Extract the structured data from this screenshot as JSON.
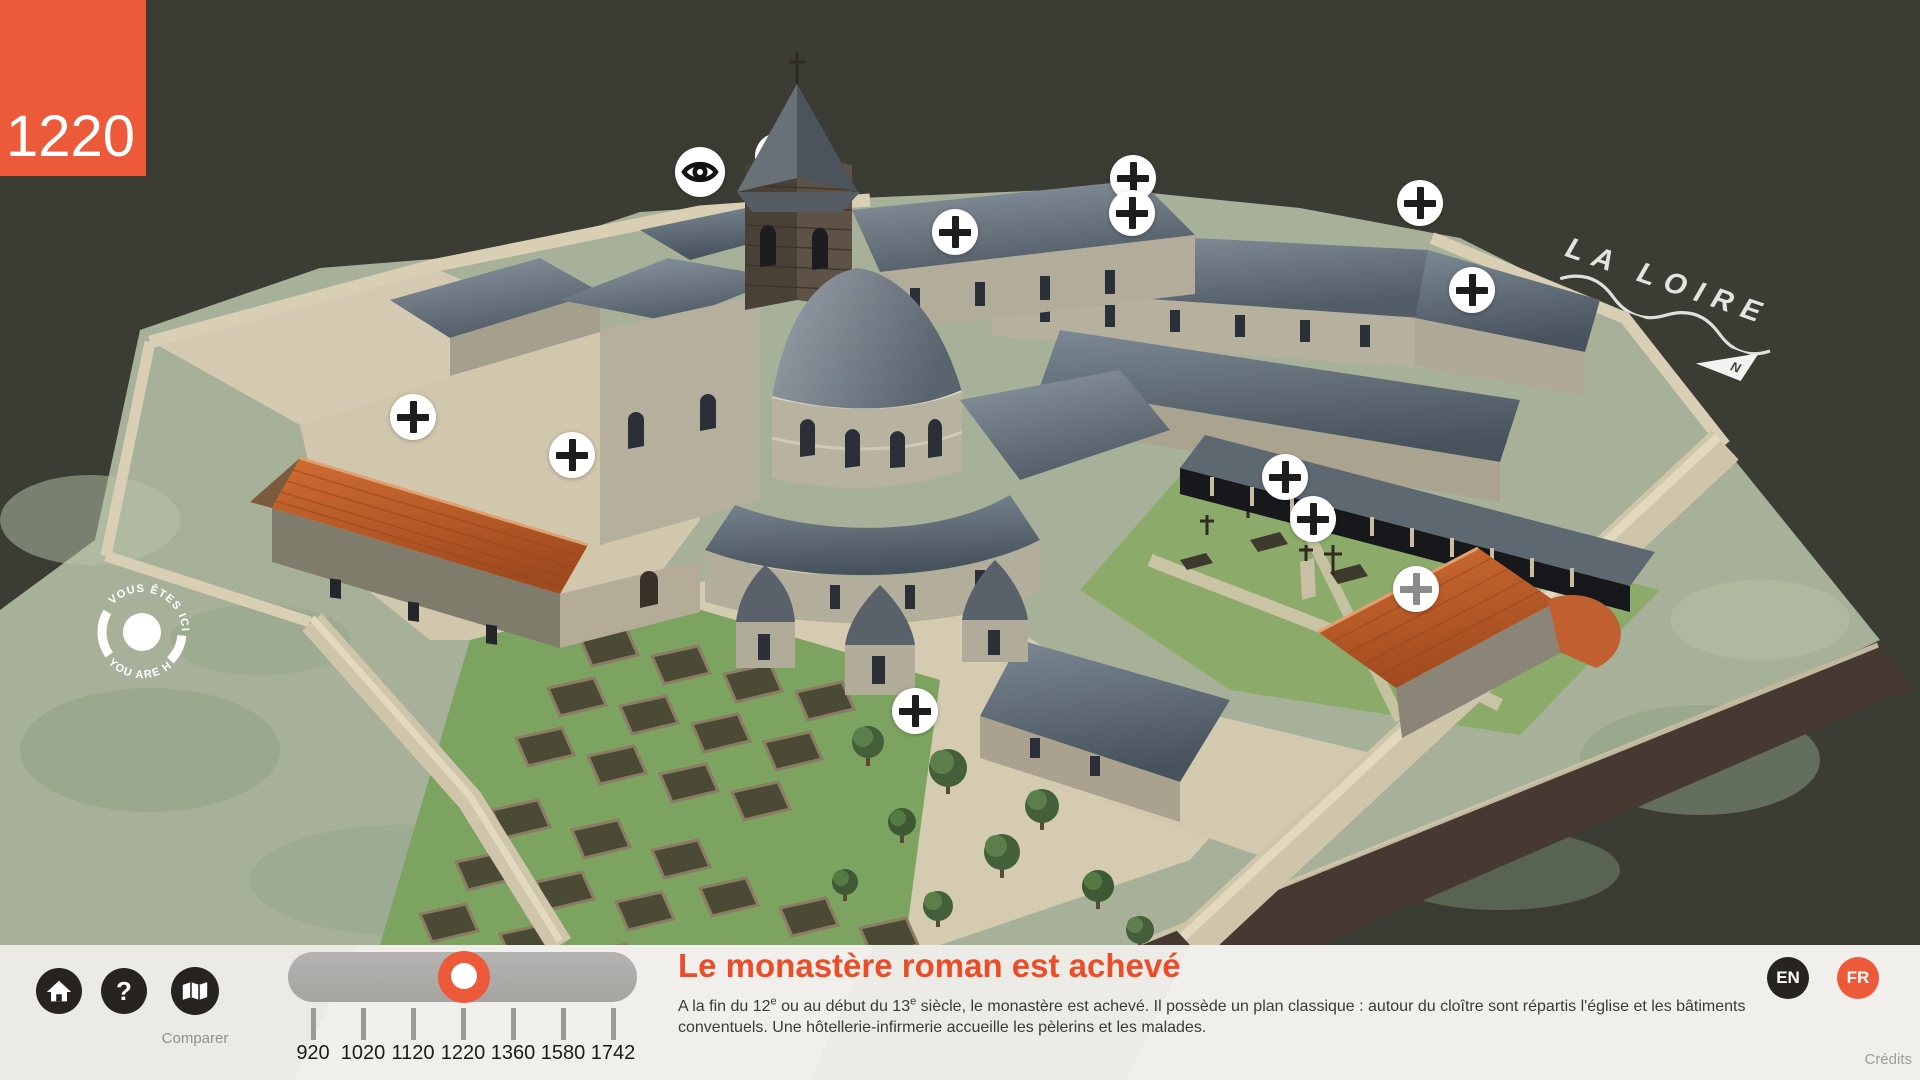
{
  "year_badge": "1220",
  "scene": {
    "river_label": "LA LOIRE",
    "north_label": "N"
  },
  "marker": {
    "line_fr": "VOUS ÊTES ICI",
    "line_en": "YOU ARE HERE"
  },
  "hotspots": [
    {
      "id": "hotspot-eye",
      "x": 700,
      "y": 172,
      "icon": "eye",
      "style": "dark"
    },
    {
      "id": "hotspot-plus-1",
      "x": 1133,
      "y": 178,
      "icon": "plus",
      "style": "dark"
    },
    {
      "id": "hotspot-plus-2",
      "x": 1132,
      "y": 213,
      "icon": "plus",
      "style": "dark"
    },
    {
      "id": "hotspot-plus-3",
      "x": 1420,
      "y": 203,
      "icon": "plus",
      "style": "dark"
    },
    {
      "id": "hotspot-plus-4",
      "x": 1472,
      "y": 290,
      "icon": "plus",
      "style": "dark"
    },
    {
      "id": "hotspot-plus-5",
      "x": 955,
      "y": 232,
      "icon": "plus",
      "style": "dark"
    },
    {
      "id": "hotspot-plus-6",
      "x": 413,
      "y": 417,
      "icon": "plus",
      "style": "dark"
    },
    {
      "id": "hotspot-plus-7",
      "x": 572,
      "y": 455,
      "icon": "plus",
      "style": "dark"
    },
    {
      "id": "hotspot-plus-8",
      "x": 1285,
      "y": 477,
      "icon": "plus",
      "style": "dark"
    },
    {
      "id": "hotspot-plus-9",
      "x": 1313,
      "y": 519,
      "icon": "plus",
      "style": "dark"
    },
    {
      "id": "hotspot-plus-10",
      "x": 1416,
      "y": 589,
      "icon": "plus",
      "style": "gray"
    },
    {
      "id": "hotspot-plus-11",
      "x": 915,
      "y": 711,
      "icon": "plus",
      "style": "dark"
    }
  ],
  "toolbar": {
    "compare_label": "Comparer"
  },
  "timeline": {
    "years": [
      "920",
      "1020",
      "1120",
      "1220",
      "1360",
      "1580",
      "1742"
    ],
    "selected": "1220"
  },
  "panel": {
    "title": "Le monastère roman est achevé",
    "description_lines": [
      [
        {
          "t": "A la fin du 12"
        },
        {
          "sup": "e"
        },
        {
          "t": " ou au début du 13"
        },
        {
          "sup": "e"
        },
        {
          "t": " siècle, le monastère est achevé. Il possède un plan classique : autour du cloître sont répartis l'église et les bâtiments"
        }
      ],
      [
        {
          "t": "conventuels. Une hôtellerie-infirmerie accueille les pèlerins et les malades."
        }
      ]
    ]
  },
  "languages": [
    {
      "code": "EN",
      "active": false
    },
    {
      "code": "FR",
      "active": true
    }
  ],
  "credits_label": "Crédits",
  "colors": {
    "accent": "#ed5a3a",
    "title": "#ed4c28",
    "dark_button": "#272320",
    "background_olive": "#3b3d35",
    "bar_background": "#f1efeb",
    "slider_track": "#a9a8a6",
    "hotspot_plus_dark": "#1d1d1d",
    "hotspot_plus_gray": "#8b8b8b"
  }
}
